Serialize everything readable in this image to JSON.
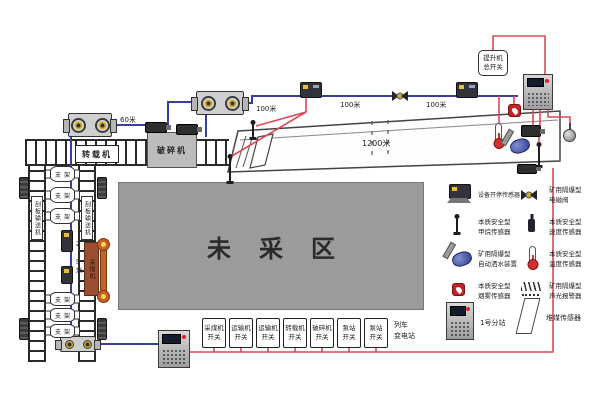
{
  "colors": {
    "trunk_blue": "#3a3f9e",
    "power_red": "#d94a57",
    "unmined_gray": "#9b9b9b"
  },
  "labels": {
    "transfer_machine": "转载机",
    "crusher": "破碎机",
    "shearer": "采煤机",
    "support": "支架",
    "unmined_area": "未采区",
    "conveyor_left": "刮板输送机",
    "conveyor_right": "刮板输送机",
    "d60": "60米",
    "d100a": "100米",
    "d100b": "100米",
    "d100c": "100米",
    "d1200": "1200米",
    "d25": "2.5米",
    "hoist_switch_line1": "提升机",
    "hoist_switch_line2": "总开关",
    "train_substation_line1": "列车",
    "train_substation_line2": "变电站"
  },
  "switches": [
    {
      "l1": "采煤机",
      "l2": "开关"
    },
    {
      "l1": "运输机",
      "l2": "开关"
    },
    {
      "l1": "运输机",
      "l2": "开关"
    },
    {
      "l1": "转载机",
      "l2": "开关"
    },
    {
      "l1": "破碎机",
      "l2": "开关"
    },
    {
      "l1": "泵站",
      "l2": "开关"
    },
    {
      "l1": "泵站",
      "l2": "开关"
    }
  ],
  "legend": {
    "items": [
      {
        "icon": "equipment-run-stop-sensor",
        "label1": "设备开停传感器",
        "label2": ""
      },
      {
        "icon": "solenoid-valve",
        "label1": "矿用隔爆型",
        "label2": "电磁阀"
      },
      {
        "icon": "methane-sensor",
        "label1": "本质安全型",
        "label2": "甲烷传感器"
      },
      {
        "icon": "speed-sensor",
        "label1": "本质安全型",
        "label2": "速度传感器"
      },
      {
        "icon": "water-spray-device",
        "label1": "矿用隔爆型",
        "label2": "自动洒水装置"
      },
      {
        "icon": "temperature-sensor",
        "label1": "本质安全型",
        "label2": "温度传感器"
      },
      {
        "icon": "smoke-sensor",
        "label1": "本质安全型",
        "label2": "烟雾传感器"
      },
      {
        "icon": "sound-light-alarm",
        "label1": "矿用隔爆型",
        "label2": "声光报警器"
      }
    ],
    "station_label": "1号分站",
    "coal_pile_label": "堆煤传感器"
  }
}
